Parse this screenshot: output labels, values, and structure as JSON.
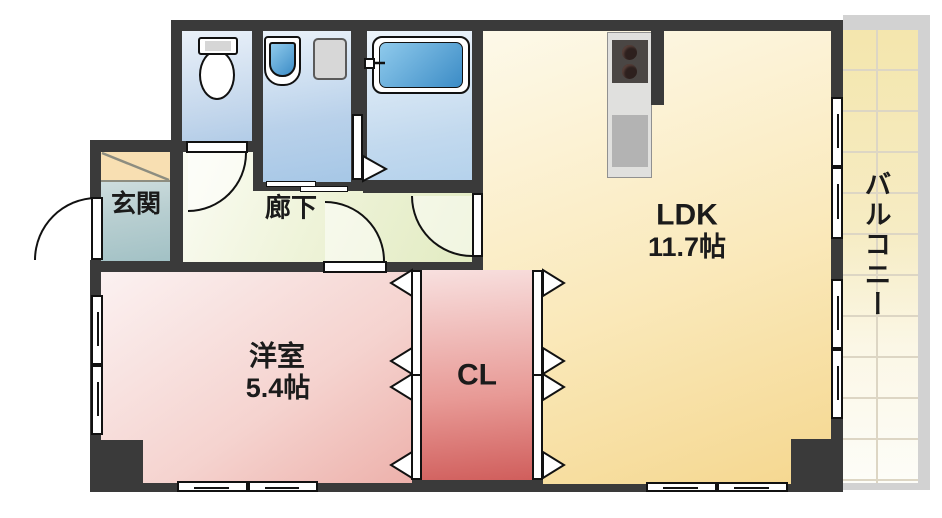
{
  "plan": {
    "type": "apartment-floor-plan",
    "rooms": {
      "entrance": {
        "label": "玄関"
      },
      "hallway": {
        "label": "廊下"
      },
      "ldk": {
        "label": "LDK",
        "size": "11.7帖"
      },
      "western": {
        "label": "洋室",
        "size": "5.4帖"
      },
      "closet": {
        "label": "CL"
      },
      "balcony": {
        "label": "バルコニー"
      }
    },
    "fixtures": [
      "toilet",
      "washbasin",
      "washing-machine",
      "bathtub",
      "kitchen-stove",
      "kitchen-sink",
      "shoe-cabinet"
    ],
    "colors": {
      "wall": "#3a3a3a",
      "ldk_floor": "#f8e3a8",
      "western_floor": "#f2c9c4",
      "closet_floor": "#d96a67",
      "hallway_floor": "#edf2d2",
      "entrance_floor": "#b9cfd1",
      "shoe_cabinet": "#f8dfb2",
      "wet_room_floor": "#c4d7ec",
      "water_blue": "#4a95cc",
      "balcony_tile": "#f4e7b0",
      "railing_gray": "#d2d2d2"
    }
  }
}
